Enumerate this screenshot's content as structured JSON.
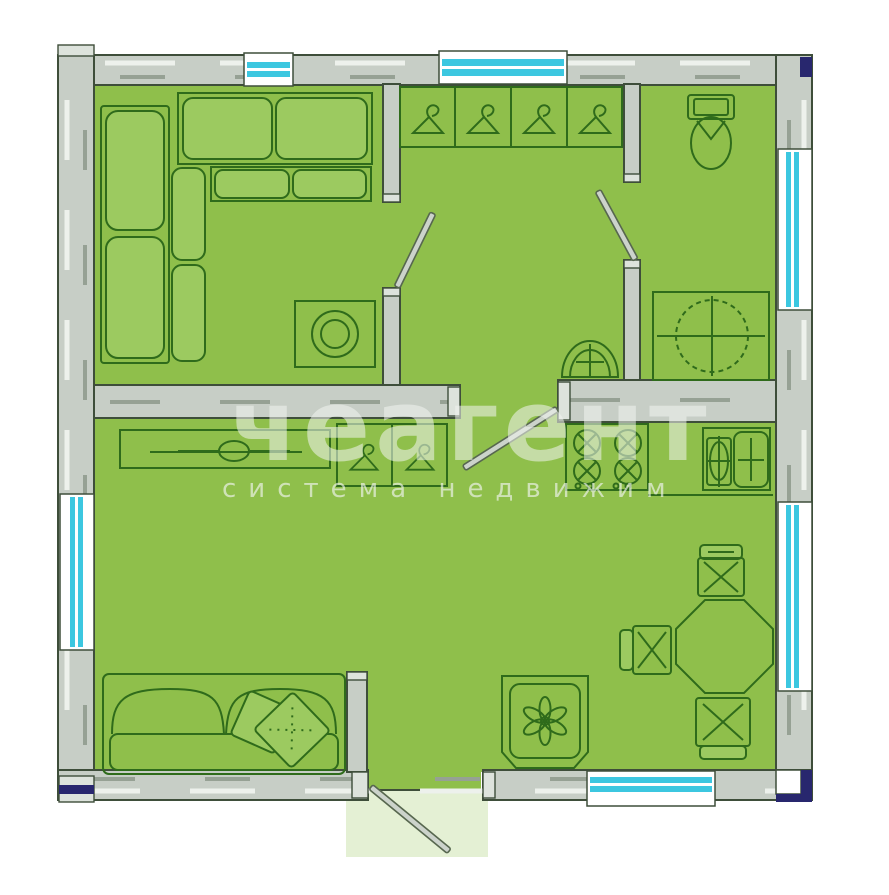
{
  "watermark": {
    "title": "чеагент",
    "subtitle": "система недвижим"
  },
  "colors": {
    "floor": "#8fbf4b",
    "floor_pale": "#e4f0d4",
    "wall_fill": "#c7cec6",
    "wall_line": "#3e4e3a",
    "wall_dash_light": "#edf1ec",
    "wall_dash_dark": "#96a194",
    "furniture_line": "#2f6b1b",
    "furniture_fill": "#9cca60",
    "glass": "#3cc7e0",
    "accent_navy": "#28276e",
    "watermark": "#f2f5f1"
  },
  "plan": {
    "type": "apartment-floor-plan",
    "windows_count": 6,
    "door_leaves_count": 4,
    "rooms": [
      {
        "name": "bedroom",
        "items": [
          "corner-sofa",
          "double-bed",
          "washing-machine"
        ]
      },
      {
        "name": "hallway",
        "items": [
          "wardrobe-4-sections",
          "wash-basin"
        ]
      },
      {
        "name": "bathroom",
        "items": [
          "toilet",
          "counter-with-round-sink"
        ]
      },
      {
        "name": "living-room",
        "items": [
          "tv-stand",
          "wardrobe-2-sections",
          "sofa-with-pillows"
        ]
      },
      {
        "name": "kitchen",
        "items": [
          "stove-4-burners",
          "kitchen-sink",
          "dining-table",
          "stool",
          "stool",
          "stool",
          "plant"
        ]
      }
    ]
  }
}
